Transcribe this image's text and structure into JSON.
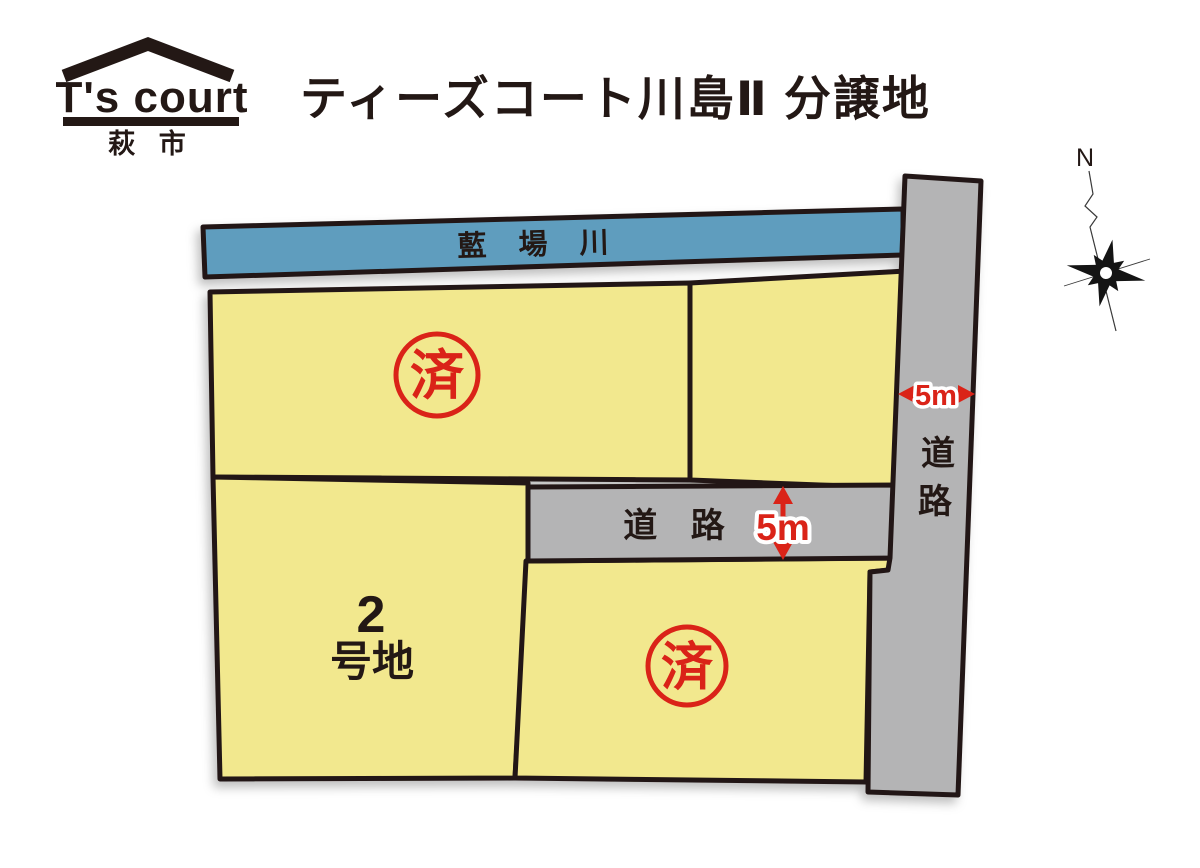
{
  "header": {
    "logo": {
      "brand": "T's court",
      "city": "萩 市",
      "roof_icon": "house-roof"
    },
    "title": "ティーズコート川島Ⅱ 分譲地"
  },
  "map": {
    "river": {
      "label": "藍 場 川"
    },
    "roads": {
      "horizontal_label": "道 路",
      "horizontal_width": "5m",
      "vertical_label_char1": "道",
      "vertical_label_char2": "路",
      "vertical_width": "5m"
    },
    "lots": {
      "lot2_line1": "2",
      "lot2_line2": "号地",
      "sold_stamp": "済"
    },
    "compass": {
      "north": "N"
    }
  },
  "colors": {
    "parcel_yellow": "#f2e88e",
    "river_blue": "#5f9dbe",
    "road_gray": "#b4b4b5",
    "outline_dark": "#231815",
    "accent_red": "#da2318"
  }
}
